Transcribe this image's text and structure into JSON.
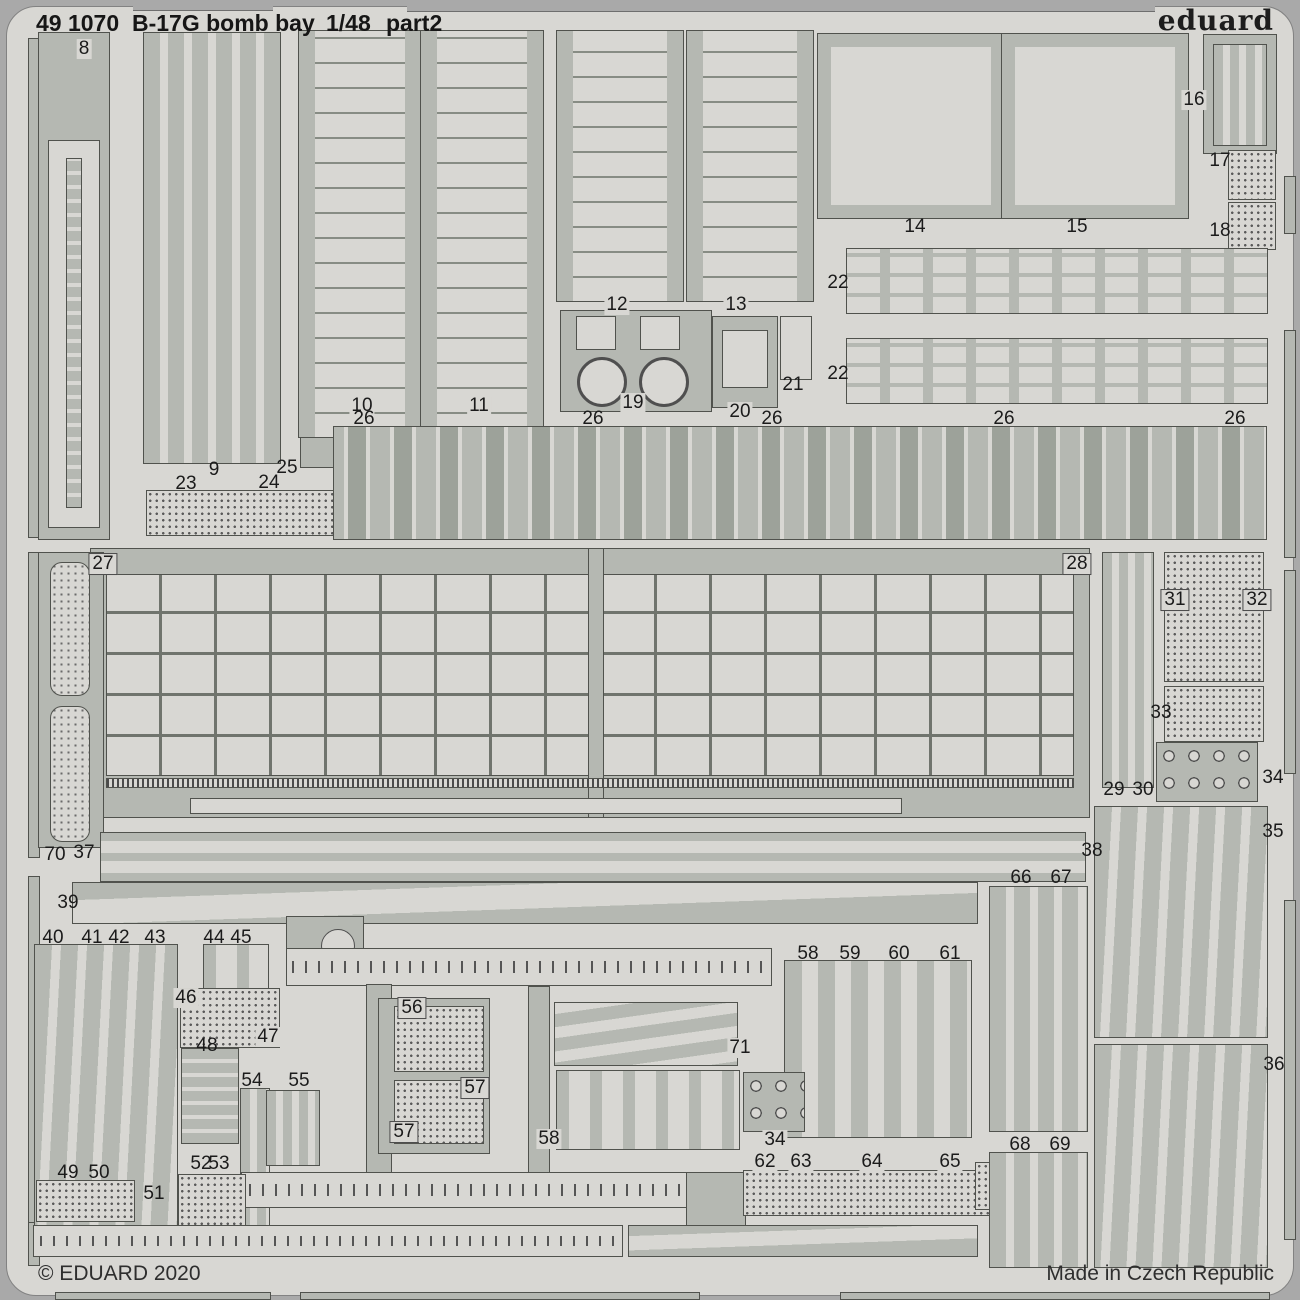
{
  "header": {
    "catalog": "49 1070",
    "title": "B-17G bomb bay",
    "scale": "1/48",
    "part": "part2",
    "brand": "eduard"
  },
  "footer": {
    "copyright": "© EDUARD 2020",
    "origin": "Made in Czech Republic"
  },
  "colors": {
    "surround": "#a9a9a9",
    "sheet": "#d8d7d3",
    "metal": "#b5b8b2",
    "outline": "#50524d",
    "text": "#1b1b1b"
  },
  "pieces": [
    {
      "x": 133,
      "y": 0,
      "w": 140,
      "h": 11,
      "k": "cut"
    },
    {
      "x": 407,
      "y": 0,
      "w": 748,
      "h": 12,
      "k": "cut"
    },
    {
      "x": 28,
      "y": 38,
      "w": 12,
      "h": 500,
      "k": "metal"
    },
    {
      "x": 28,
      "y": 552,
      "w": 12,
      "h": 306,
      "k": "metal"
    },
    {
      "x": 28,
      "y": 876,
      "w": 12,
      "h": 348,
      "k": "metal"
    },
    {
      "x": 28,
      "y": 1222,
      "w": 12,
      "h": 44,
      "k": "metal"
    },
    {
      "x": 1284,
      "y": 176,
      "w": 12,
      "h": 58,
      "k": "metal"
    },
    {
      "x": 1284,
      "y": 330,
      "w": 12,
      "h": 228,
      "k": "metal"
    },
    {
      "x": 1284,
      "y": 570,
      "w": 12,
      "h": 204,
      "k": "metal"
    },
    {
      "x": 1284,
      "y": 900,
      "w": 12,
      "h": 340,
      "k": "metal"
    },
    {
      "x": 55,
      "y": 1292,
      "w": 216,
      "h": 8,
      "k": "metal"
    },
    {
      "x": 300,
      "y": 1292,
      "w": 400,
      "h": 8,
      "k": "metal"
    },
    {
      "x": 840,
      "y": 1292,
      "w": 430,
      "h": 8,
      "k": "metal"
    },
    {
      "x": 38,
      "y": 32,
      "w": 72,
      "h": 508,
      "k": "metal"
    },
    {
      "x": 48,
      "y": 140,
      "w": 52,
      "h": 388,
      "k": "light"
    },
    {
      "x": 66,
      "y": 158,
      "w": 16,
      "h": 350,
      "k": "hbars"
    },
    {
      "x": 143,
      "y": 32,
      "w": 138,
      "h": 432,
      "k": "vstrips"
    },
    {
      "x": 146,
      "y": 490,
      "w": 196,
      "h": 46,
      "k": "dots"
    },
    {
      "x": 300,
      "y": 424,
      "w": 38,
      "h": 44,
      "k": "metal"
    },
    {
      "x": 298,
      "y": 30,
      "w": 124,
      "h": 408,
      "k": "hex"
    },
    {
      "x": 420,
      "y": 30,
      "w": 124,
      "h": 408,
      "k": "hex"
    },
    {
      "x": 556,
      "y": 30,
      "w": 128,
      "h": 272,
      "k": "hex"
    },
    {
      "x": 686,
      "y": 30,
      "w": 128,
      "h": 272,
      "k": "hex"
    },
    {
      "x": 560,
      "y": 310,
      "w": 152,
      "h": 102,
      "k": "winch"
    },
    {
      "x": 576,
      "y": 316,
      "w": 40,
      "h": 34,
      "k": "light"
    },
    {
      "x": 640,
      "y": 316,
      "w": 40,
      "h": 34,
      "k": "light"
    },
    {
      "x": 712,
      "y": 316,
      "w": 66,
      "h": 92,
      "k": "metal"
    },
    {
      "x": 722,
      "y": 330,
      "w": 46,
      "h": 58,
      "k": "light"
    },
    {
      "x": 780,
      "y": 316,
      "w": 32,
      "h": 64,
      "k": "light"
    },
    {
      "x": 818,
      "y": 34,
      "w": 186,
      "h": 184,
      "k": "door"
    },
    {
      "x": 1002,
      "y": 34,
      "w": 186,
      "h": 184,
      "k": "door"
    },
    {
      "x": 1203,
      "y": 34,
      "w": 74,
      "h": 120,
      "k": "metal"
    },
    {
      "x": 1213,
      "y": 44,
      "w": 54,
      "h": 102,
      "k": "vstrips-n"
    },
    {
      "x": 1228,
      "y": 150,
      "w": 48,
      "h": 50,
      "k": "dots"
    },
    {
      "x": 1228,
      "y": 202,
      "w": 48,
      "h": 48,
      "k": "dots"
    },
    {
      "x": 846,
      "y": 248,
      "w": 422,
      "h": 66,
      "k": "slotrow"
    },
    {
      "x": 846,
      "y": 338,
      "w": 422,
      "h": 66,
      "k": "slotrow"
    },
    {
      "x": 333,
      "y": 426,
      "w": 934,
      "h": 114,
      "k": "ribrow"
    },
    {
      "x": 90,
      "y": 548,
      "w": 1000,
      "h": 270,
      "k": "metal"
    },
    {
      "x": 106,
      "y": 574,
      "w": 968,
      "h": 202,
      "k": "grid"
    },
    {
      "x": 588,
      "y": 548,
      "w": 16,
      "h": 270,
      "k": "metal"
    },
    {
      "x": 106,
      "y": 778,
      "w": 968,
      "h": 10,
      "k": "ticks"
    },
    {
      "x": 190,
      "y": 798,
      "w": 712,
      "h": 16,
      "k": "light"
    },
    {
      "x": 38,
      "y": 552,
      "w": 66,
      "h": 296,
      "k": "metal"
    },
    {
      "x": 50,
      "y": 562,
      "w": 40,
      "h": 134,
      "k": "pods"
    },
    {
      "x": 50,
      "y": 706,
      "w": 40,
      "h": 136,
      "k": "pods"
    },
    {
      "x": 100,
      "y": 832,
      "w": 986,
      "h": 50,
      "k": "rail2"
    },
    {
      "x": 1102,
      "y": 552,
      "w": 52,
      "h": 236,
      "k": "vstrips-n"
    },
    {
      "x": 1164,
      "y": 552,
      "w": 100,
      "h": 130,
      "k": "dots"
    },
    {
      "x": 1164,
      "y": 686,
      "w": 100,
      "h": 56,
      "k": "dots"
    },
    {
      "x": 1156,
      "y": 742,
      "w": 102,
      "h": 60,
      "k": "rings"
    },
    {
      "x": 1094,
      "y": 806,
      "w": 174,
      "h": 232,
      "k": "blades"
    },
    {
      "x": 1094,
      "y": 1044,
      "w": 174,
      "h": 224,
      "k": "blades"
    },
    {
      "x": 72,
      "y": 882,
      "w": 906,
      "h": 42,
      "k": "taper"
    },
    {
      "x": 34,
      "y": 944,
      "w": 144,
      "h": 294,
      "k": "blades"
    },
    {
      "x": 203,
      "y": 944,
      "w": 66,
      "h": 52,
      "k": "vslotrow"
    },
    {
      "x": 180,
      "y": 988,
      "w": 100,
      "h": 60,
      "k": "dots"
    },
    {
      "x": 181,
      "y": 1048,
      "w": 58,
      "h": 96,
      "k": "hbars"
    },
    {
      "x": 286,
      "y": 916,
      "w": 78,
      "h": 64,
      "k": "gusset"
    },
    {
      "x": 286,
      "y": 948,
      "w": 486,
      "h": 38,
      "k": "rail"
    },
    {
      "x": 366,
      "y": 984,
      "w": 26,
      "h": 192,
      "k": "metal"
    },
    {
      "x": 528,
      "y": 986,
      "w": 22,
      "h": 190,
      "k": "metal"
    },
    {
      "x": 240,
      "y": 1088,
      "w": 30,
      "h": 154,
      "k": "vstrips-n"
    },
    {
      "x": 266,
      "y": 1090,
      "w": 54,
      "h": 76,
      "k": "vstrips-n"
    },
    {
      "x": 378,
      "y": 998,
      "w": 112,
      "h": 156,
      "k": "metal"
    },
    {
      "x": 394,
      "y": 1006,
      "w": 90,
      "h": 66,
      "k": "dots"
    },
    {
      "x": 394,
      "y": 1080,
      "w": 90,
      "h": 64,
      "k": "dots"
    },
    {
      "x": 554,
      "y": 1002,
      "w": 184,
      "h": 64,
      "k": "hslats2"
    },
    {
      "x": 556,
      "y": 1070,
      "w": 184,
      "h": 80,
      "k": "vslotrow"
    },
    {
      "x": 784,
      "y": 960,
      "w": 188,
      "h": 178,
      "k": "vslats"
    },
    {
      "x": 743,
      "y": 1072,
      "w": 62,
      "h": 60,
      "k": "rings"
    },
    {
      "x": 241,
      "y": 1172,
      "w": 744,
      "h": 36,
      "k": "rail"
    },
    {
      "x": 686,
      "y": 1172,
      "w": 60,
      "h": 56,
      "k": "metal"
    },
    {
      "x": 743,
      "y": 1170,
      "w": 272,
      "h": 46,
      "k": "dots"
    },
    {
      "x": 975,
      "y": 1162,
      "w": 28,
      "h": 48,
      "k": "dots"
    },
    {
      "x": 989,
      "y": 886,
      "w": 99,
      "h": 246,
      "k": "vstrips"
    },
    {
      "x": 989,
      "y": 1152,
      "w": 99,
      "h": 116,
      "k": "vstrips"
    },
    {
      "x": 36,
      "y": 1180,
      "w": 99,
      "h": 42,
      "k": "dots"
    },
    {
      "x": 178,
      "y": 1174,
      "w": 68,
      "h": 52,
      "k": "dots"
    },
    {
      "x": 33,
      "y": 1225,
      "w": 590,
      "h": 32,
      "k": "rail"
    },
    {
      "x": 628,
      "y": 1225,
      "w": 350,
      "h": 32,
      "k": "taper"
    }
  ],
  "labels": [
    {
      "t": "8",
      "x": 84,
      "y": 49,
      "b": 2
    },
    {
      "t": "9",
      "x": 214,
      "y": 470
    },
    {
      "t": "10",
      "x": 362,
      "y": 406,
      "b": 2
    },
    {
      "t": "11",
      "x": 479,
      "y": 406,
      "b": 2
    },
    {
      "t": "12",
      "x": 617,
      "y": 305,
      "b": 2
    },
    {
      "t": "13",
      "x": 736,
      "y": 305,
      "b": 2
    },
    {
      "t": "14",
      "x": 915,
      "y": 227
    },
    {
      "t": "15",
      "x": 1077,
      "y": 227
    },
    {
      "t": "16",
      "x": 1194,
      "y": 100,
      "b": 2
    },
    {
      "t": "17",
      "x": 1220,
      "y": 161
    },
    {
      "t": "18",
      "x": 1220,
      "y": 231
    },
    {
      "t": "19",
      "x": 633,
      "y": 403,
      "b": 2
    },
    {
      "t": "20",
      "x": 740,
      "y": 412,
      "b": 2
    },
    {
      "t": "21",
      "x": 793,
      "y": 385
    },
    {
      "t": "22",
      "x": 838,
      "y": 283
    },
    {
      "t": "22",
      "x": 838,
      "y": 374
    },
    {
      "t": "23",
      "x": 186,
      "y": 484
    },
    {
      "t": "24",
      "x": 269,
      "y": 483
    },
    {
      "t": "25",
      "x": 287,
      "y": 468
    },
    {
      "t": "26",
      "x": 364,
      "y": 419
    },
    {
      "t": "26",
      "x": 593,
      "y": 419
    },
    {
      "t": "26",
      "x": 772,
      "y": 419
    },
    {
      "t": "26",
      "x": 1004,
      "y": 419
    },
    {
      "t": "26",
      "x": 1235,
      "y": 419
    },
    {
      "t": "27",
      "x": 103,
      "y": 564,
      "b": 1
    },
    {
      "t": "28",
      "x": 1077,
      "y": 564,
      "b": 1
    },
    {
      "t": "29",
      "x": 1114,
      "y": 790
    },
    {
      "t": "30",
      "x": 1143,
      "y": 790
    },
    {
      "t": "31",
      "x": 1175,
      "y": 600,
      "b": 1
    },
    {
      "t": "32",
      "x": 1257,
      "y": 600,
      "b": 1
    },
    {
      "t": "33",
      "x": 1161,
      "y": 713
    },
    {
      "t": "34",
      "x": 1273,
      "y": 778
    },
    {
      "t": "34",
      "x": 775,
      "y": 1140,
      "b": 2
    },
    {
      "t": "35",
      "x": 1273,
      "y": 832
    },
    {
      "t": "36",
      "x": 1274,
      "y": 1065
    },
    {
      "t": "37",
      "x": 84,
      "y": 853
    },
    {
      "t": "38",
      "x": 1092,
      "y": 851
    },
    {
      "t": "39",
      "x": 68,
      "y": 903
    },
    {
      "t": "40",
      "x": 53,
      "y": 938
    },
    {
      "t": "41",
      "x": 92,
      "y": 938
    },
    {
      "t": "42",
      "x": 119,
      "y": 938
    },
    {
      "t": "43",
      "x": 155,
      "y": 938
    },
    {
      "t": "44",
      "x": 214,
      "y": 938
    },
    {
      "t": "45",
      "x": 241,
      "y": 938
    },
    {
      "t": "46",
      "x": 186,
      "y": 998,
      "b": 2
    },
    {
      "t": "47",
      "x": 268,
      "y": 1037,
      "b": 2
    },
    {
      "t": "48",
      "x": 207,
      "y": 1046
    },
    {
      "t": "49",
      "x": 68,
      "y": 1173
    },
    {
      "t": "50",
      "x": 99,
      "y": 1173
    },
    {
      "t": "51",
      "x": 154,
      "y": 1194
    },
    {
      "t": "52",
      "x": 201,
      "y": 1164
    },
    {
      "t": "53",
      "x": 219,
      "y": 1164
    },
    {
      "t": "54",
      "x": 252,
      "y": 1081
    },
    {
      "t": "55",
      "x": 299,
      "y": 1081
    },
    {
      "t": "56",
      "x": 412,
      "y": 1008,
      "b": 1
    },
    {
      "t": "57",
      "x": 475,
      "y": 1088,
      "b": 1
    },
    {
      "t": "57",
      "x": 404,
      "y": 1132,
      "b": 1
    },
    {
      "t": "58",
      "x": 549,
      "y": 1139,
      "b": 2
    },
    {
      "t": "58",
      "x": 808,
      "y": 954
    },
    {
      "t": "59",
      "x": 850,
      "y": 954
    },
    {
      "t": "60",
      "x": 899,
      "y": 954
    },
    {
      "t": "61",
      "x": 950,
      "y": 954
    },
    {
      "t": "62",
      "x": 765,
      "y": 1162,
      "b": 2
    },
    {
      "t": "63",
      "x": 801,
      "y": 1162,
      "b": 2
    },
    {
      "t": "64",
      "x": 872,
      "y": 1162,
      "b": 2
    },
    {
      "t": "65",
      "x": 950,
      "y": 1162,
      "b": 2
    },
    {
      "t": "66",
      "x": 1021,
      "y": 878
    },
    {
      "t": "67",
      "x": 1061,
      "y": 878
    },
    {
      "t": "68",
      "x": 1020,
      "y": 1145
    },
    {
      "t": "69",
      "x": 1060,
      "y": 1145
    },
    {
      "t": "70",
      "x": 55,
      "y": 855
    },
    {
      "t": "71",
      "x": 740,
      "y": 1048,
      "b": 2
    }
  ]
}
